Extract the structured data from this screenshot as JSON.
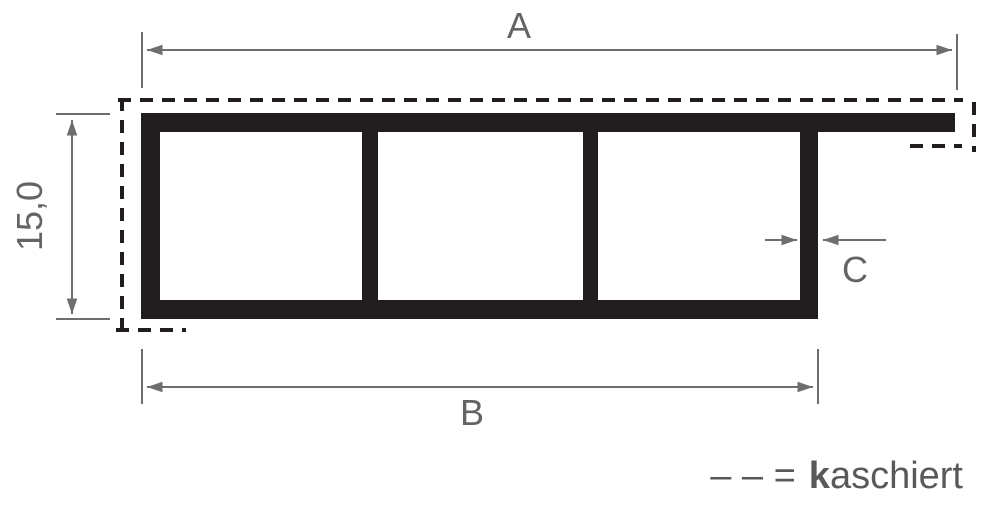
{
  "diagram": {
    "dimension_labels": {
      "width_total": "A",
      "width_profile": "B",
      "wall_thickness": "C",
      "height": "15,0"
    },
    "legend": {
      "dash_symbol": "– – =",
      "term_bold": "k",
      "term_rest": "aschiert"
    },
    "colors": {
      "profile_fill": "#211d1e",
      "dashed_outline": "#211d1e",
      "dimension_lines": "#6d6e70",
      "label_text": "#636466",
      "background": "#ffffff"
    }
  }
}
